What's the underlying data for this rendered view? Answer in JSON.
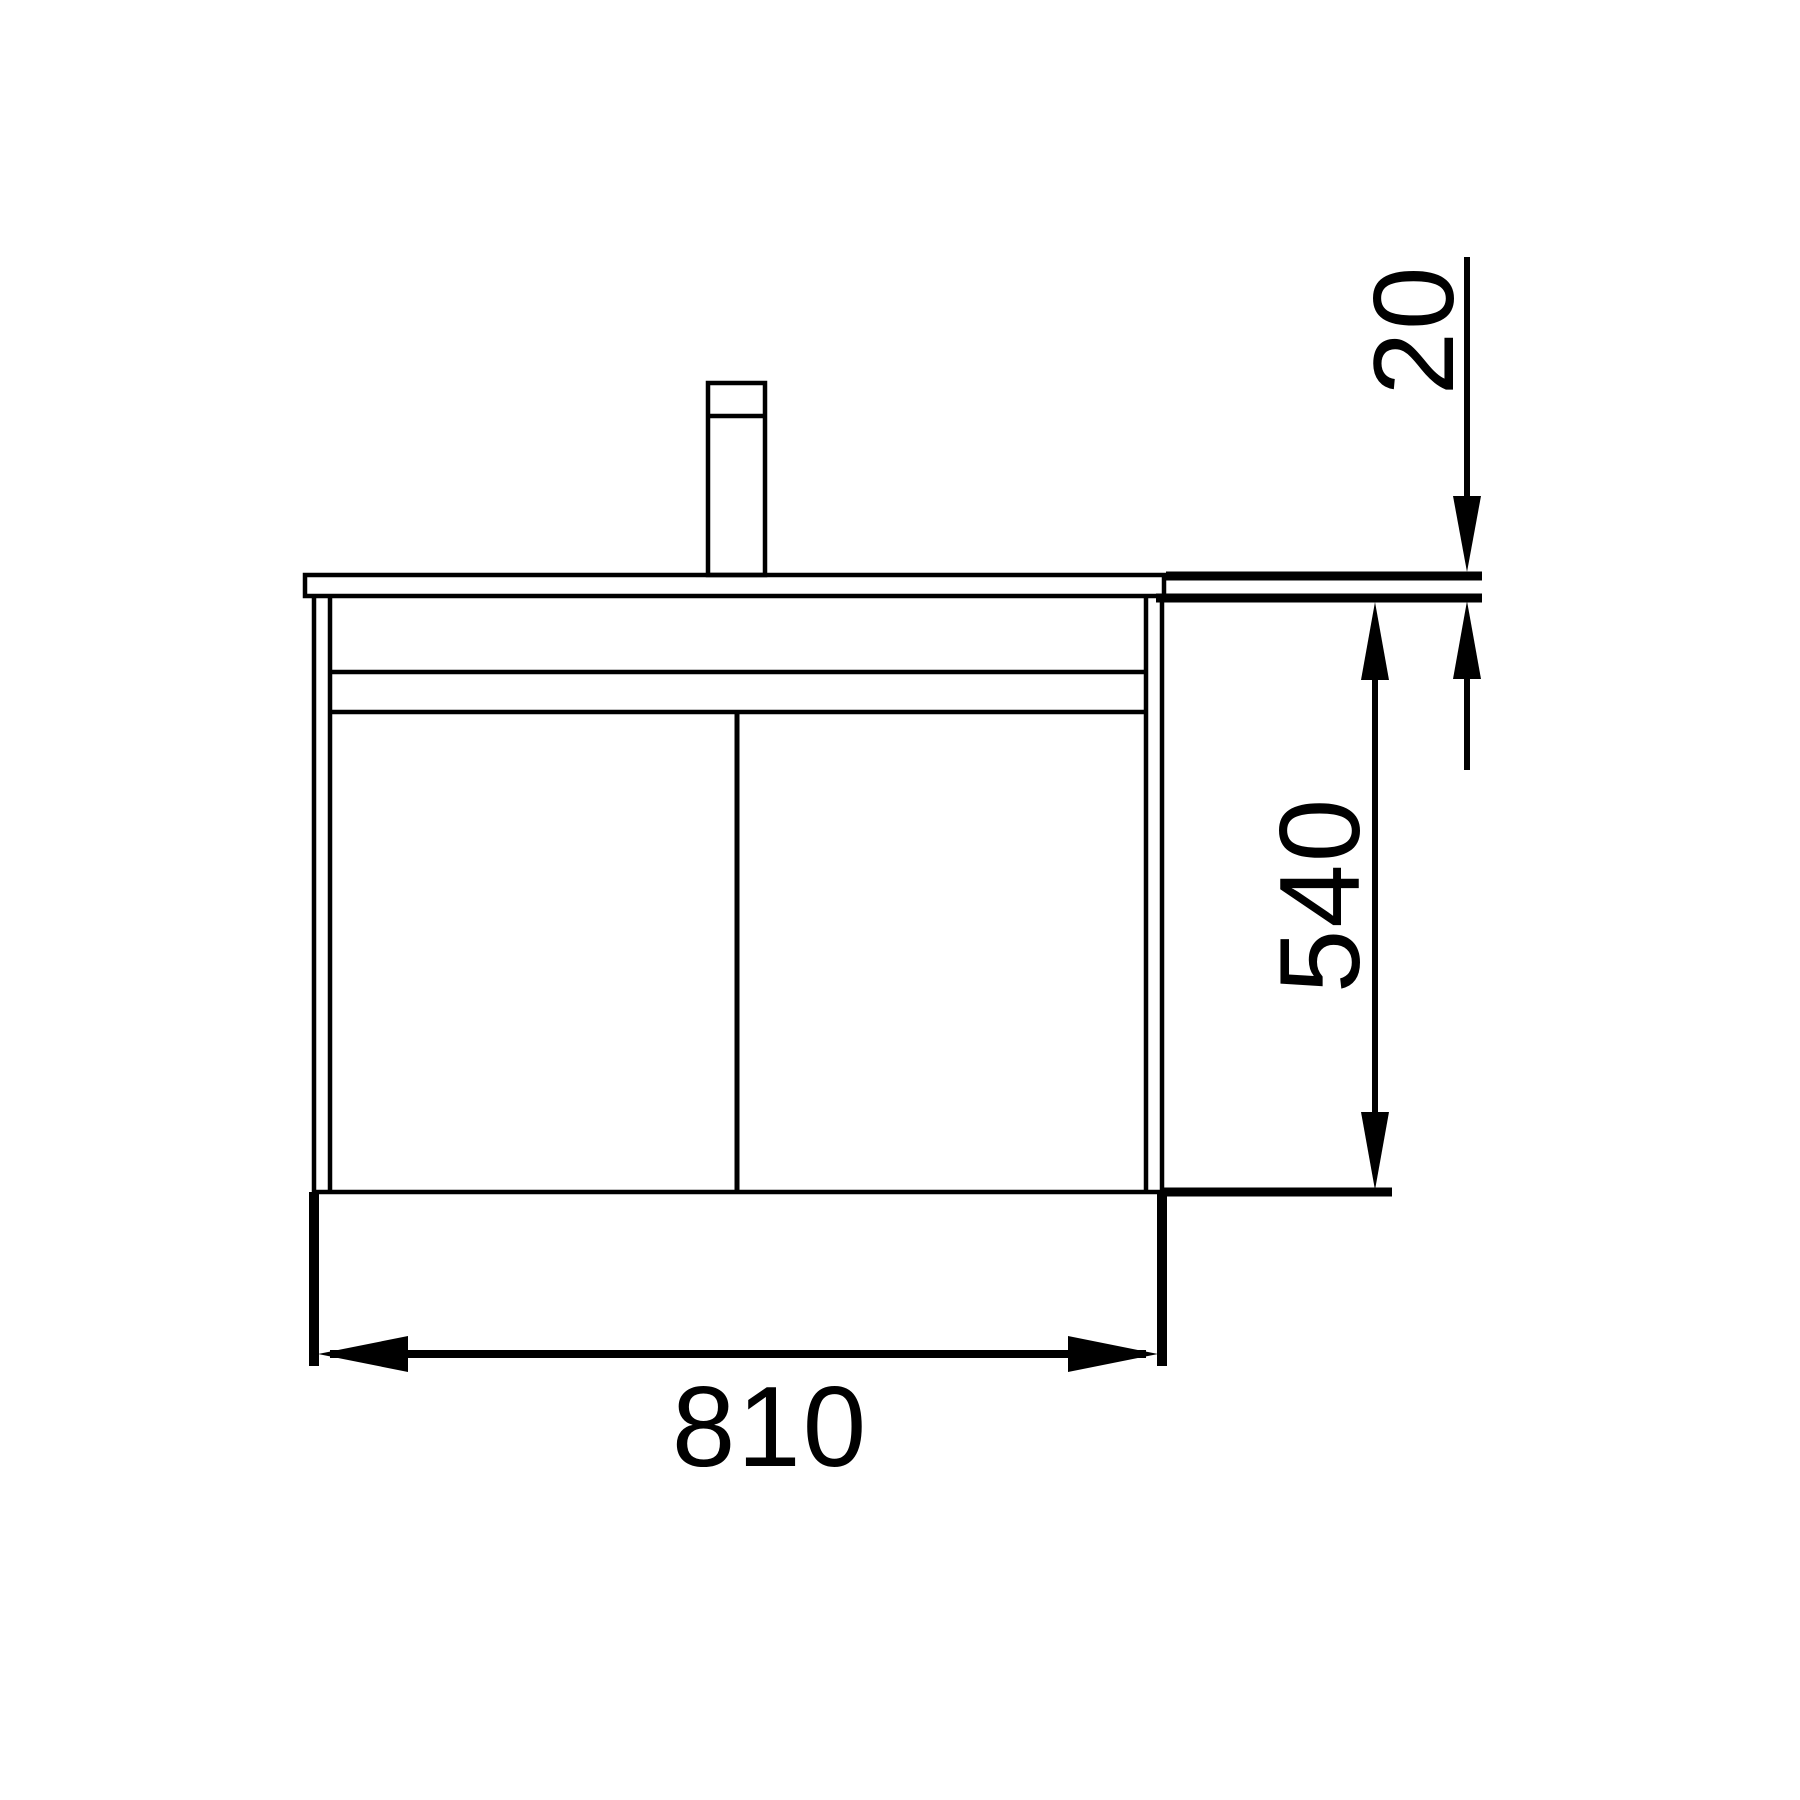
{
  "drawing": {
    "type": "technical-elevation",
    "subject": "wall-hung vanity cabinet with basin counter and faucet, front view",
    "dimension_labels": {
      "width": "810",
      "cabinet_height": "540",
      "counter_thickness": "20"
    },
    "colors": {
      "line": "#000000",
      "background": "#ffffff"
    }
  }
}
